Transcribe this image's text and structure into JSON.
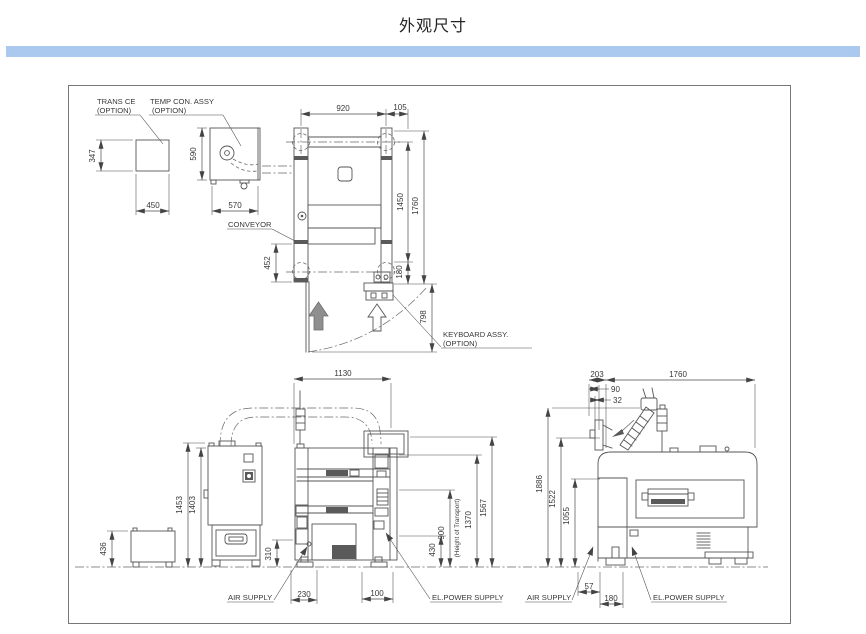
{
  "title": "外观尺寸",
  "accent_color": "#abc8ef",
  "labels": {
    "trans_ce_line1": "TRANS CE",
    "trans_ce_line2": "(OPTION)",
    "temp_con_line1": "TEMP CON. ASSY",
    "temp_con_line2": "(OPTION)",
    "conveyor": "CONVEYOR",
    "keyboard_line1": "KEYBOARD ASSY.",
    "keyboard_line2": "(OPTION)",
    "height_of_transport": "(Height of Transport)",
    "air_supply_front": "AIR SUPPLY",
    "el_power_front": "EL.POWER SUPPLY",
    "air_supply_side": "AIR SUPPLY",
    "el_power_side": "EL.POWER SUPPLY"
  },
  "dims": {
    "plan": {
      "width_920": "920",
      "width_105": "105",
      "height_1450": "1450",
      "height_1760": "1760",
      "height_180": "180",
      "height_798": "798",
      "height_452": "452"
    },
    "trans_box": {
      "height_347": "347",
      "width_450": "450"
    },
    "temp_box": {
      "height_590": "590",
      "width_570": "570"
    },
    "front": {
      "width_1130": "1130",
      "height_1453": "1453",
      "height_1403": "1403",
      "height_436": "436",
      "height_310": "310",
      "width_230": "230",
      "width_100": "100",
      "height_430": "430",
      "height_900": "900",
      "height_1370": "1370",
      "height_1567": "1567"
    },
    "side": {
      "width_203": "203",
      "width_1760": "1760",
      "width_90": "90",
      "width_32": "32",
      "height_1886": "1886",
      "height_1522": "1522",
      "height_1055": "1055",
      "width_57": "57",
      "width_180": "180"
    }
  }
}
